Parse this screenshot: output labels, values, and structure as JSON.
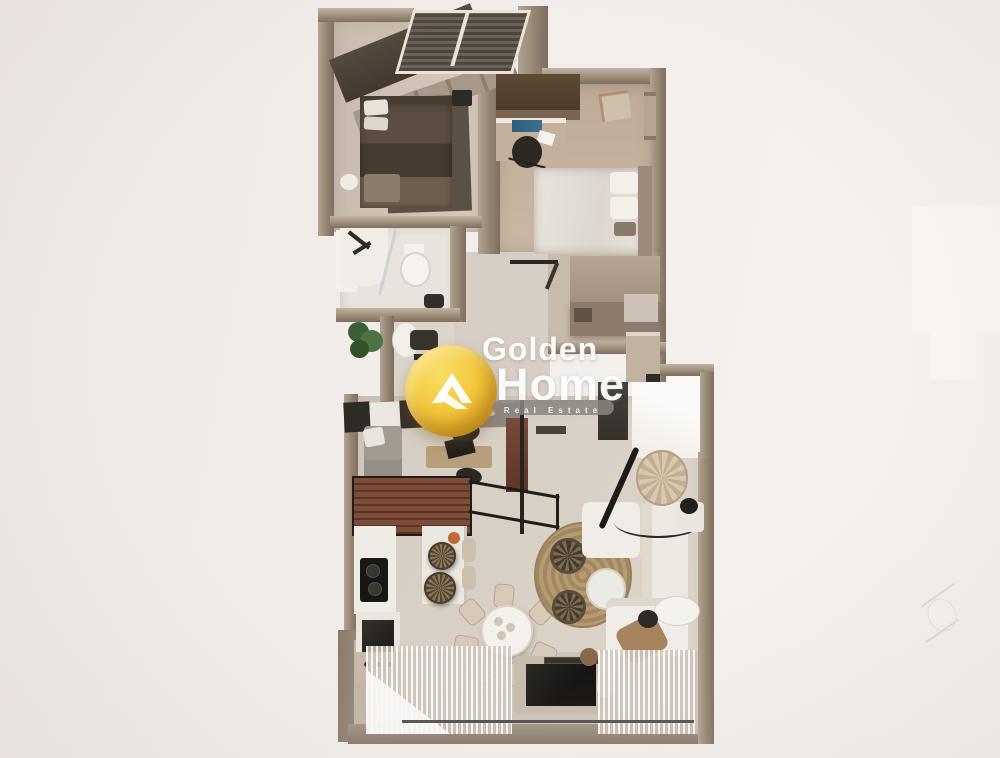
{
  "image": {
    "kind": "3d-apartment-floor-plan-top-view-render",
    "background_color": "#f2eeec"
  },
  "watermark": {
    "brand_line1": "Golden",
    "brand_line2": "Home",
    "tagline": "Real Estate",
    "logo_icon": "golden-home-house-icon",
    "colors": {
      "gold": "#eec23a",
      "gold_deep": "#c9951f",
      "text": "#ffffff",
      "tagline_band": "#8b8680"
    }
  },
  "palette": {
    "wall": "#93836f",
    "floor_light": "#d9d1c7",
    "floor_wood": "#c6b5a3",
    "bathroom_floor": "#e8e3dc",
    "dark_furniture": "#2e2a26",
    "dark_bed": "#4e4337",
    "white_furniture": "#efece7",
    "deck_wood": "#7d4d39",
    "jute_rug": "#b59a74",
    "plant_green": "#44683c"
  },
  "rooms": [
    {
      "name": "bedroom-1"
    },
    {
      "name": "bedroom-2"
    },
    {
      "name": "bathroom"
    },
    {
      "name": "wc"
    },
    {
      "name": "hallway"
    },
    {
      "name": "walk-in-closet"
    },
    {
      "name": "kitchen"
    },
    {
      "name": "dining-area"
    },
    {
      "name": "living-room"
    },
    {
      "name": "balcony"
    }
  ]
}
